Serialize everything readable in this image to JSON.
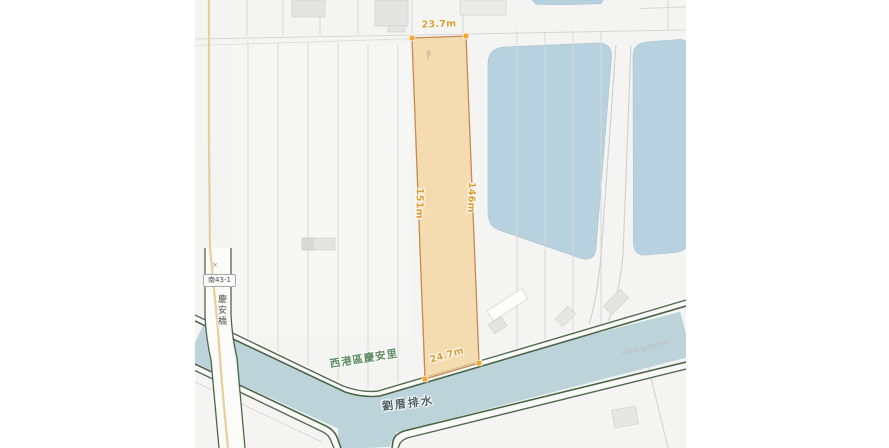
{
  "map": {
    "type": "cadastral-parcel-map",
    "parcel": {
      "marker": "光3",
      "measurements": {
        "top": "23.7m",
        "right": "146m",
        "bottom": "24.7m",
        "left": "151m"
      },
      "fill": "#f5d7a4",
      "stroke": "#c6894f",
      "vertex_color": "#f2a735",
      "measure_label_color": "#dc9c2e"
    },
    "labels": {
      "village": "西港區慶安里",
      "drainage": "劉厝排水",
      "road_number": "南43-1",
      "bridge": "慶安橋",
      "cross_mark": "×",
      "watermark": "nlsc.gov.tw"
    },
    "colors": {
      "map_background": "#f4f4f2",
      "pond_water": "#b7d2de",
      "channel_water": "#bcd4d9",
      "bank_green": "#44603f",
      "field_line": "#d7d7d2",
      "building": "#e4e4e2",
      "path_yellow": "#e6cf9b",
      "village_label": "#5d8b60",
      "drainage_label": "#4b5f63"
    }
  }
}
